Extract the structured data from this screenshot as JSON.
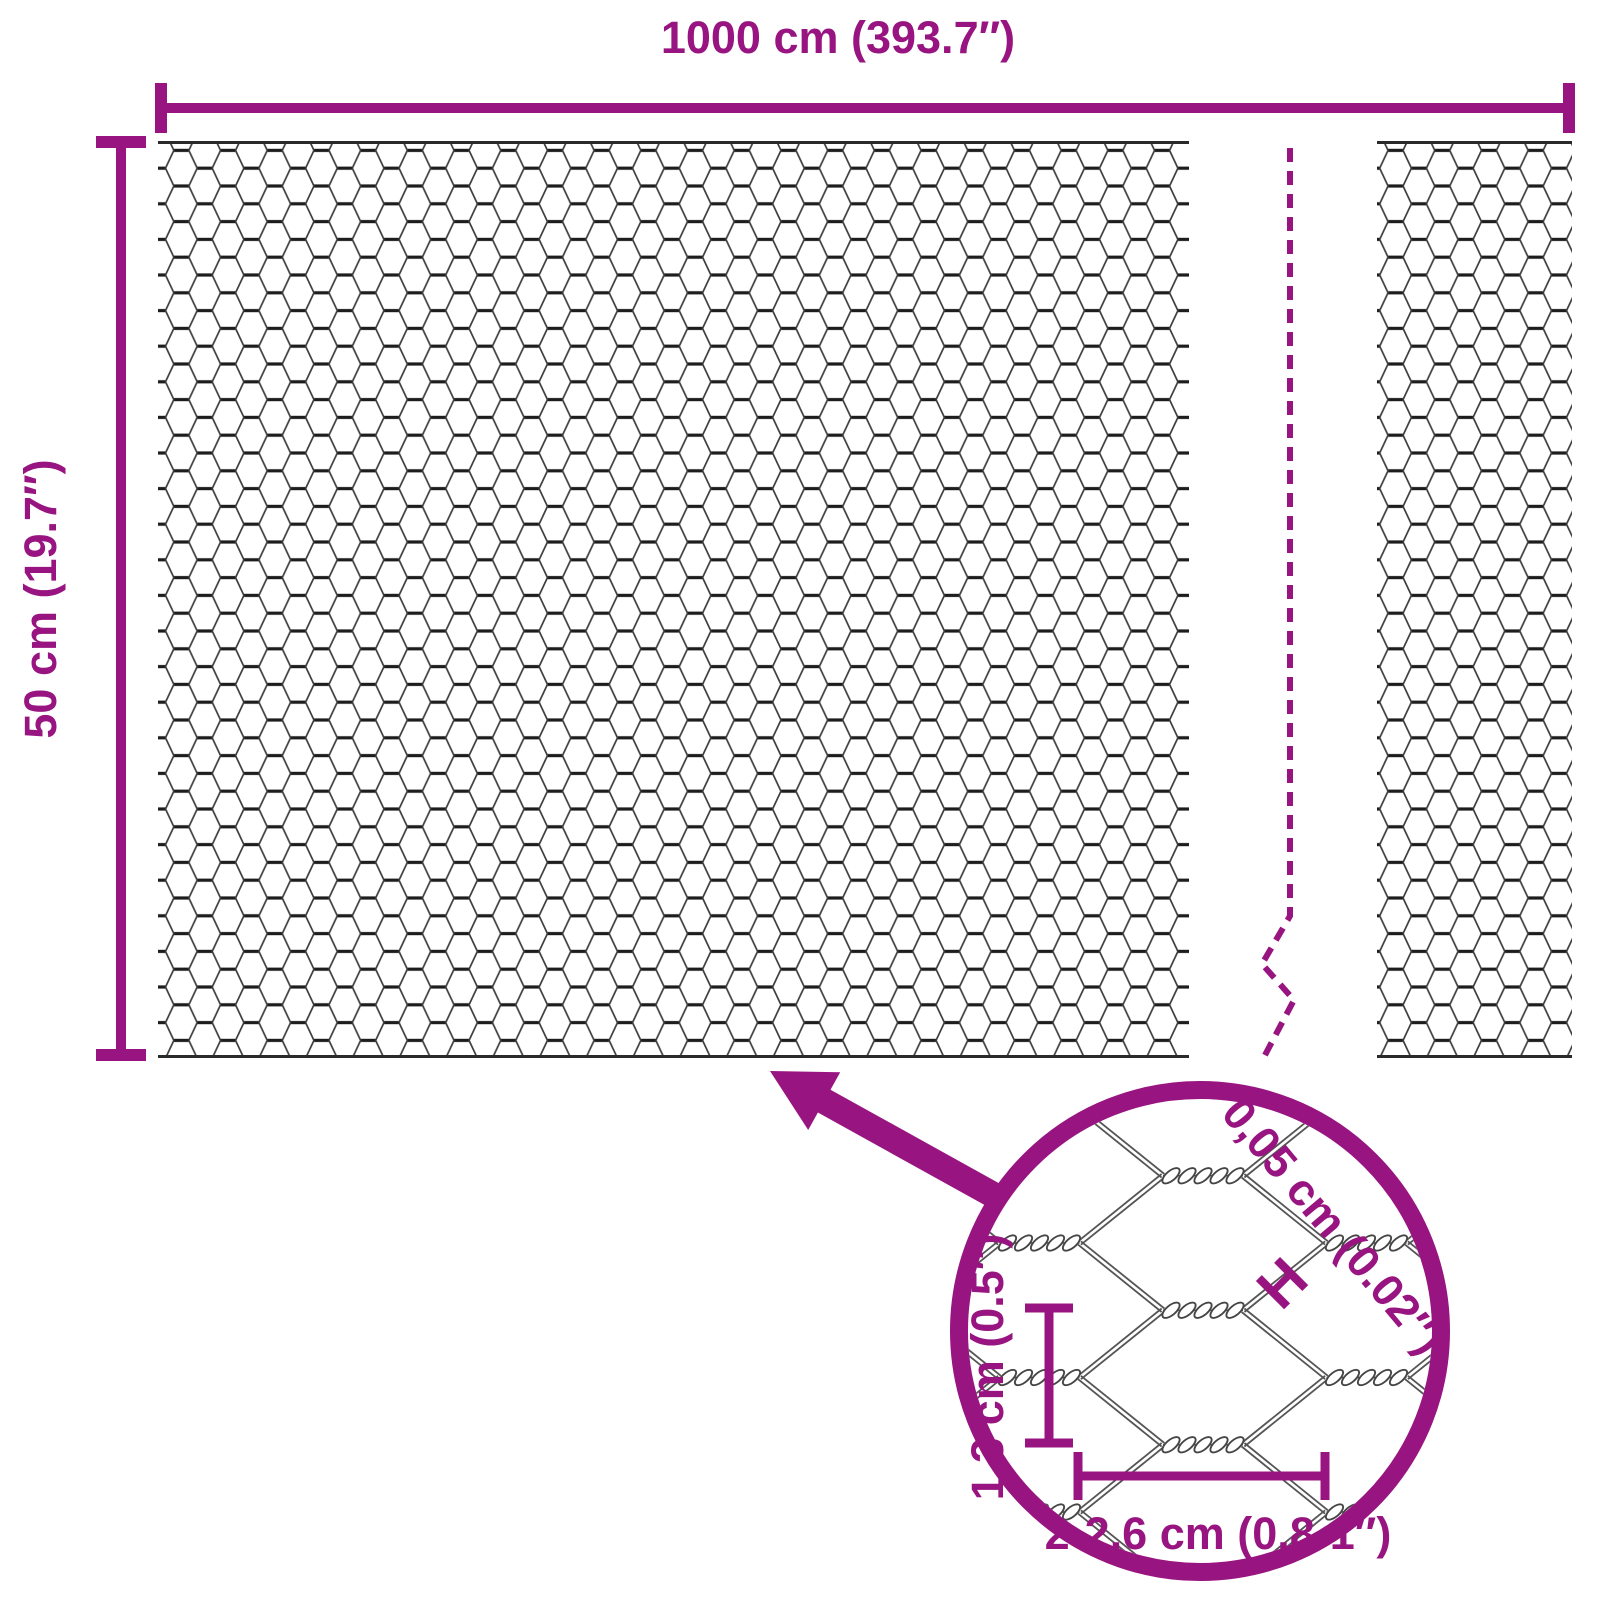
{
  "diagram": {
    "background_color": "#ffffff",
    "accent_color": "#981480",
    "wire_color": "#3d3d3d",
    "overall_width": {
      "label": "1000 cm (393.7″)"
    },
    "overall_height": {
      "label": "50 cm (19.7″)"
    },
    "zoom_detail": {
      "wire_thickness": {
        "label": "0,05 cm (0.02″)",
        "marker_glyph": "H"
      },
      "opening_height": {
        "label": "1,3 cm (0.5″)"
      },
      "opening_width": {
        "label": "2-2,6 cm (0.8-1″)"
      }
    },
    "icons": {
      "arrow": "zoom-arrow-icon",
      "magnifier_circle": "zoom-circle-icon",
      "break_line": "break-line-icon"
    }
  }
}
